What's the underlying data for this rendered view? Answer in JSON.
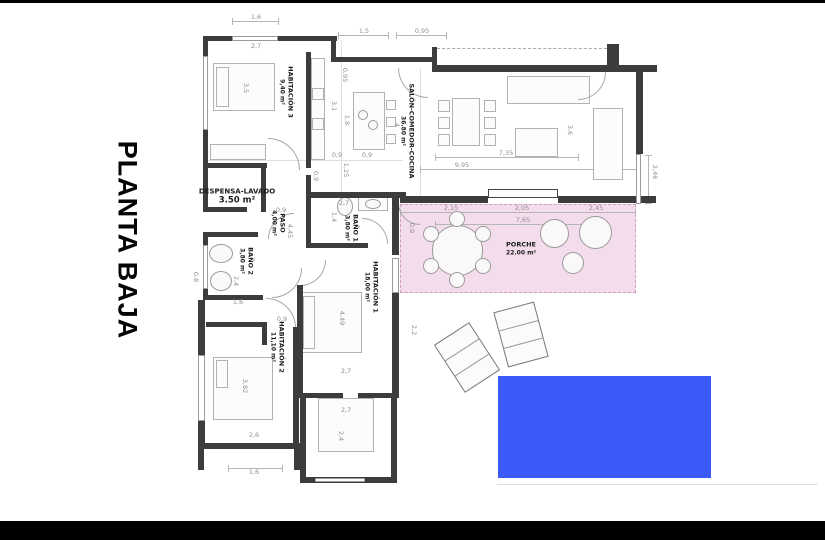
{
  "page": {
    "title": "PLANTA BAJA"
  },
  "colors": {
    "wall": "#3c3c3c",
    "thin_line": "#b5b5b5",
    "porch_fill": "#f3dceb",
    "porch_border": "#d09cbe",
    "pool_blue": "#3c5af8",
    "dim_text": "#8f8f8f",
    "label_text": "#1d1d1d",
    "letterbox": "#000000"
  },
  "rooms": [
    {
      "name": "HABITACIÓN 3",
      "area": "9,40 m²",
      "cx": 286,
      "cy": 92,
      "rot": true,
      "big": false,
      "left": false
    },
    {
      "name": "SALÓN-COMEDOR-COCINA",
      "area": "36.80 m²",
      "cx": 407,
      "cy": 131,
      "rot": true,
      "big": false,
      "left": false
    },
    {
      "name": "DESPENSA-LAVADO",
      "area": "3.50 m²",
      "cx": 237,
      "cy": 197,
      "rot": false,
      "big": true,
      "left": false
    },
    {
      "name": "PASO",
      "area": "4,00 m²",
      "cx": 278,
      "cy": 223,
      "rot": true,
      "big": false,
      "left": false
    },
    {
      "name": "BAÑO 1",
      "area": "3,80 m²",
      "cx": 351,
      "cy": 228,
      "rot": true,
      "big": false,
      "left": false
    },
    {
      "name": "BAÑO 2",
      "area": "3,80 m²",
      "cx": 246,
      "cy": 261,
      "rot": true,
      "big": false,
      "left": false
    },
    {
      "name": "HABITACIÓN 1",
      "area": "18,00 m²",
      "cx": 371,
      "cy": 287,
      "rot": true,
      "big": false,
      "left": false
    },
    {
      "name": "HABITACIÓN 2",
      "area": "11,10 m²",
      "cx": 277,
      "cy": 347,
      "rot": true,
      "big": false,
      "left": false
    },
    {
      "name": "PORCHE",
      "area": "22.00 m²",
      "cx": 521,
      "cy": 249,
      "rot": false,
      "big": false,
      "left": true
    }
  ],
  "dimensions": [
    {
      "text": "1,6",
      "x": 256,
      "y": 17,
      "rot": false
    },
    {
      "text": "2,7",
      "x": 256,
      "y": 46,
      "rot": false
    },
    {
      "text": "1,5",
      "x": 364,
      "y": 31,
      "rot": false
    },
    {
      "text": "0,95",
      "x": 422,
      "y": 31,
      "rot": false
    },
    {
      "text": "0,95",
      "x": 345,
      "y": 75,
      "rot": true
    },
    {
      "text": "3,1",
      "x": 334,
      "y": 106,
      "rot": true
    },
    {
      "text": "3,5",
      "x": 246,
      "y": 88,
      "rot": true
    },
    {
      "text": "1,8",
      "x": 347,
      "y": 120,
      "rot": true
    },
    {
      "text": "4",
      "x": 397,
      "y": 125,
      "rot": true
    },
    {
      "text": "3,6",
      "x": 570,
      "y": 130,
      "rot": true
    },
    {
      "text": "0,9",
      "x": 337,
      "y": 155,
      "rot": false
    },
    {
      "text": "0,9",
      "x": 367,
      "y": 155,
      "rot": false
    },
    {
      "text": "7,35",
      "x": 506,
      "y": 153,
      "rot": false
    },
    {
      "text": "9,95",
      "x": 462,
      "y": 165,
      "rot": false
    },
    {
      "text": "1,25",
      "x": 346,
      "y": 170,
      "rot": true
    },
    {
      "text": "0,9",
      "x": 316,
      "y": 176,
      "rot": true
    },
    {
      "text": "2,46",
      "x": 655,
      "y": 172,
      "rot": true
    },
    {
      "text": "0,9",
      "x": 281,
      "y": 210,
      "rot": false
    },
    {
      "text": "2,15",
      "x": 451,
      "y": 208,
      "rot": false
    },
    {
      "text": "2,05",
      "x": 522,
      "y": 208,
      "rot": false
    },
    {
      "text": "2,45",
      "x": 596,
      "y": 208,
      "rot": false
    },
    {
      "text": "7,65",
      "x": 523,
      "y": 220,
      "rot": false
    },
    {
      "text": "0,9",
      "x": 412,
      "y": 228,
      "rot": true
    },
    {
      "text": "2,7",
      "x": 344,
      "y": 203,
      "rot": false
    },
    {
      "text": "1,4",
      "x": 334,
      "y": 217,
      "rot": true
    },
    {
      "text": "4,45",
      "x": 290,
      "y": 231,
      "rot": true
    },
    {
      "text": "2,4",
      "x": 236,
      "y": 281,
      "rot": true
    },
    {
      "text": "0,8",
      "x": 196,
      "y": 277,
      "rot": true
    },
    {
      "text": "1,6",
      "x": 238,
      "y": 302,
      "rot": false
    },
    {
      "text": "0,9",
      "x": 282,
      "y": 319,
      "rot": false
    },
    {
      "text": "4,49",
      "x": 342,
      "y": 318,
      "rot": true
    },
    {
      "text": "2,2",
      "x": 414,
      "y": 330,
      "rot": true
    },
    {
      "text": "3,82",
      "x": 245,
      "y": 386,
      "rot": true
    },
    {
      "text": "2,7",
      "x": 346,
      "y": 371,
      "rot": false
    },
    {
      "text": "2,7",
      "x": 346,
      "y": 410,
      "rot": false
    },
    {
      "text": "2,4",
      "x": 341,
      "y": 436,
      "rot": true
    },
    {
      "text": "2,6",
      "x": 254,
      "y": 435,
      "rot": false
    },
    {
      "text": "1,6",
      "x": 254,
      "y": 472,
      "rot": false
    }
  ]
}
